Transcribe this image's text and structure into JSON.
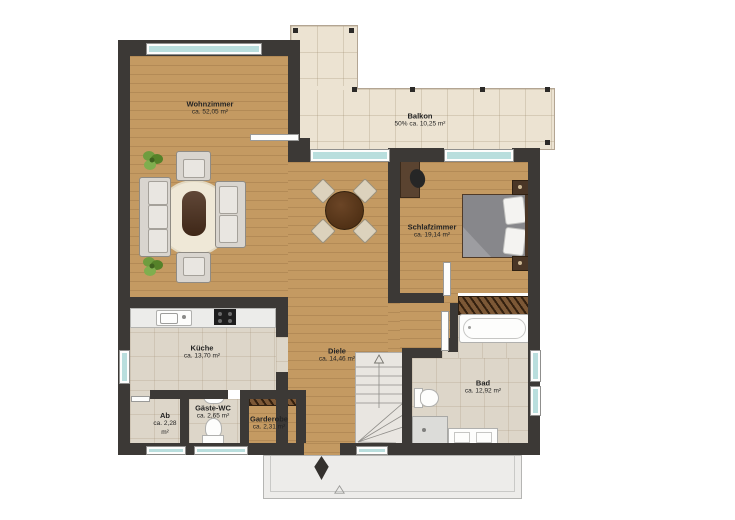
{
  "plan": {
    "rooms": [
      {
        "name": "Wohnzimmer",
        "area": "ca. 52,05 m²"
      },
      {
        "name": "Balkon",
        "area": "50% ca. 10,25 m²"
      },
      {
        "name": "Schlafzimmer",
        "area": "ca. 19,14 m²"
      },
      {
        "name": "Küche",
        "area": "ca. 13,70 m²"
      },
      {
        "name": "Diele",
        "area": "ca. 14,46 m²"
      },
      {
        "name": "Bad",
        "area": "ca. 12,92 m²"
      },
      {
        "name": "Gäste-WC",
        "area": "ca. 2,65 m²"
      },
      {
        "name": "Garderobe",
        "area": "ca. 2,31 m²"
      },
      {
        "name": "Ab",
        "area": "ca. 2,28 m²"
      }
    ],
    "icons": {
      "entrance_arrow": "▲",
      "stairs_direction_arrow": "△",
      "porch_marker": "△"
    },
    "colors": {
      "wall": "#3c3936",
      "wood_floor": "#c49a62",
      "tile_floor": "#ddd6c9",
      "balcony_floor": "#ece3d2",
      "window_glass": "#b9dedd",
      "closet_wood": "#7c5836",
      "rug": "#efe8d7",
      "bed_duvet": "#87878b",
      "plant_green": "#6f9d3f"
    }
  }
}
